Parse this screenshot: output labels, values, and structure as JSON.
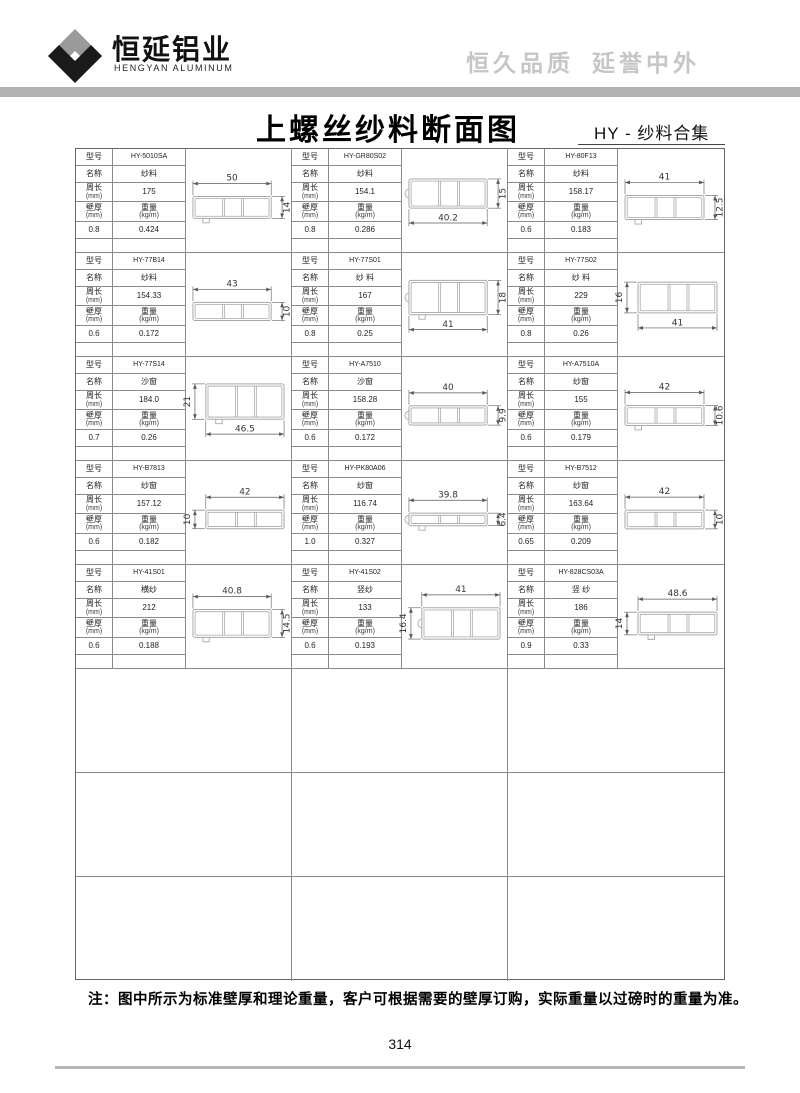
{
  "header": {
    "company_name": "恒延铝业",
    "company_name_en": "HENGYAN ALUMINUM",
    "slogan_left": "恒久品质",
    "slogan_right": "延誉中外"
  },
  "title": {
    "main": "上螺丝纱料断面图",
    "sub": "HY - 纱料合集"
  },
  "table_labels": {
    "model": "型号",
    "name": "名称",
    "perimeter": "周长",
    "thickness": "壁厚",
    "weight": "重量",
    "unit_mm": "(mm)",
    "unit_kgm": "(kg/m)"
  },
  "profiles": [
    {
      "model": "HY-5010SA",
      "name": "纱料",
      "perimeter": "175",
      "thickness": "0.8",
      "weight": "0.424",
      "dims": [
        {
          "label": "50",
          "pos": "top"
        },
        {
          "label": "14",
          "pos": "right"
        }
      ]
    },
    {
      "model": "HY-GR80S02",
      "name": "纱料",
      "perimeter": "154.1",
      "thickness": "0.8",
      "weight": "0.286",
      "dims": [
        {
          "label": "40.2",
          "pos": "bottom"
        },
        {
          "label": "15",
          "pos": "right"
        }
      ]
    },
    {
      "model": "HY-80F13",
      "name": "纱料",
      "perimeter": "158.17",
      "thickness": "0.6",
      "weight": "0.183",
      "dims": [
        {
          "label": "41",
          "pos": "top"
        },
        {
          "label": "12.5",
          "pos": "right"
        }
      ]
    },
    {
      "model": "HY-77B14",
      "name": "纱料",
      "perimeter": "154.33",
      "thickness": "0.6",
      "weight": "0.172",
      "dims": [
        {
          "label": "43",
          "pos": "top"
        },
        {
          "label": "10",
          "pos": "right"
        }
      ]
    },
    {
      "model": "HY-77S01",
      "name": "纱 料",
      "perimeter": "167",
      "thickness": "0.8",
      "weight": "0.25",
      "dims": [
        {
          "label": "41",
          "pos": "bottom"
        },
        {
          "label": "18",
          "pos": "right"
        }
      ]
    },
    {
      "model": "HY-77S02",
      "name": "纱 料",
      "perimeter": "229",
      "thickness": "0.8",
      "weight": "0.26",
      "dims": [
        {
          "label": "41",
          "pos": "bottom"
        },
        {
          "label": "16",
          "pos": "left"
        }
      ]
    },
    {
      "model": "HY-77S14",
      "name": "沙窗",
      "perimeter": "184.0",
      "thickness": "0.7",
      "weight": "0.26",
      "dims": [
        {
          "label": "46.5",
          "pos": "bottom"
        },
        {
          "label": "21",
          "pos": "left"
        }
      ]
    },
    {
      "model": "HY-A7510",
      "name": "沙窗",
      "perimeter": "158.28",
      "thickness": "0.6",
      "weight": "0.172",
      "dims": [
        {
          "label": "40",
          "pos": "top"
        },
        {
          "label": "9.9",
          "pos": "right"
        }
      ]
    },
    {
      "model": "HY-A7510A",
      "name": "纱窗",
      "perimeter": "155",
      "thickness": "0.6",
      "weight": "0.179",
      "dims": [
        {
          "label": "42",
          "pos": "top"
        },
        {
          "label": "10.6",
          "pos": "right"
        }
      ]
    },
    {
      "model": "HY-B7813",
      "name": "纱窗",
      "perimeter": "157.12",
      "thickness": "0.6",
      "weight": "0.182",
      "dims": [
        {
          "label": "42",
          "pos": "top"
        },
        {
          "label": "10",
          "pos": "left"
        }
      ]
    },
    {
      "model": "HY-PK80A06",
      "name": "纱窗",
      "perimeter": "116.74",
      "thickness": "1.0",
      "weight": "0.327",
      "dims": [
        {
          "label": "39.8",
          "pos": "top"
        },
        {
          "label": "6.4",
          "pos": "right"
        }
      ]
    },
    {
      "model": "HY-B7512",
      "name": "纱窗",
      "perimeter": "163.64",
      "thickness": "0.65",
      "weight": "0.209",
      "dims": [
        {
          "label": "42",
          "pos": "top"
        },
        {
          "label": "10",
          "pos": "right"
        }
      ]
    },
    {
      "model": "HY-41S01",
      "name": "横纱",
      "perimeter": "212",
      "thickness": "0.6",
      "weight": "0.188",
      "dims": [
        {
          "label": "40.8",
          "pos": "top"
        },
        {
          "label": "14.5",
          "pos": "right"
        }
      ]
    },
    {
      "model": "HY-41S02",
      "name": "竖纱",
      "perimeter": "133",
      "thickness": "0.6",
      "weight": "0.193",
      "dims": [
        {
          "label": "41",
          "pos": "top"
        },
        {
          "label": "16.4",
          "pos": "left"
        }
      ]
    },
    {
      "model": "HY-828CS03A",
      "name": "竖 纱",
      "perimeter": "186",
      "thickness": "0.9",
      "weight": "0.33",
      "dims": [
        {
          "label": "48.6",
          "pos": "top"
        },
        {
          "label": "14",
          "pos": "left"
        }
      ]
    }
  ],
  "empty_rows": 3,
  "footer": {
    "note": "注：图中所示为标准壁厚和理论重量，客户可根据需要的壁厚订购，实际重量以过磅时的重量为准。",
    "page_number": "314"
  },
  "colors": {
    "header_bar": "#b2b2b2",
    "slogan_gray": "#c6c6c6",
    "grid_line": "#8a8a8a",
    "profile_stroke": "#a8a8a8",
    "dimension_stroke": "#5a5a5a",
    "logo_gray": "#9a9a9a",
    "logo_black": "#1a1a1a"
  }
}
